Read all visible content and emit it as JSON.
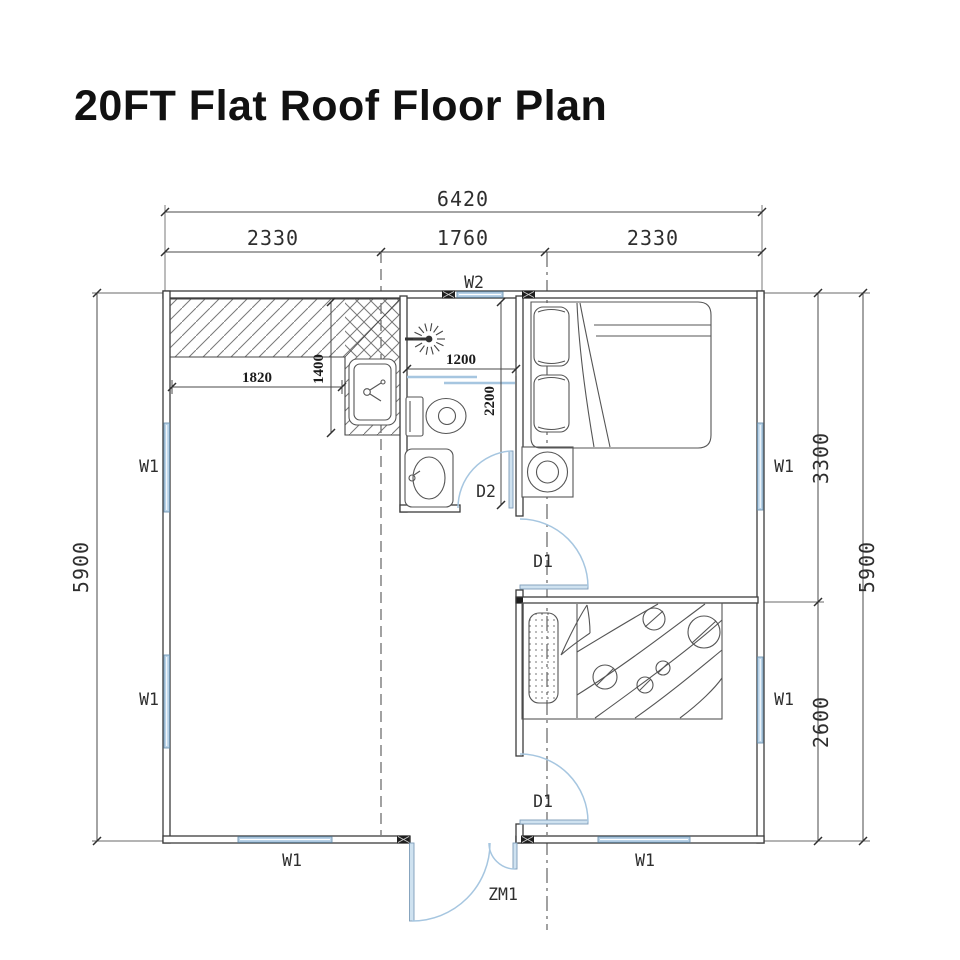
{
  "title": "20FT Flat Roof Floor Plan",
  "dims": {
    "overall_width": "6420",
    "top_segments": [
      "2330",
      "1760",
      "2330"
    ],
    "left_height": "5900",
    "right_total": "5900",
    "right_upper": "3300",
    "right_lower": "2600",
    "counter_width": "1820",
    "counter_depth": "1400",
    "shower_width": "1200",
    "bath_depth": "2200"
  },
  "labels": {
    "window_main": "W1",
    "window_small": "W2",
    "door_room": "D1",
    "door_bath": "D2",
    "door_entry": "ZM1"
  },
  "colors": {
    "window_fill": "#b8d2e8",
    "door_arc": "#a6c6e0",
    "wall_line": "#3c3c3c",
    "text": "#2e2e2e"
  }
}
